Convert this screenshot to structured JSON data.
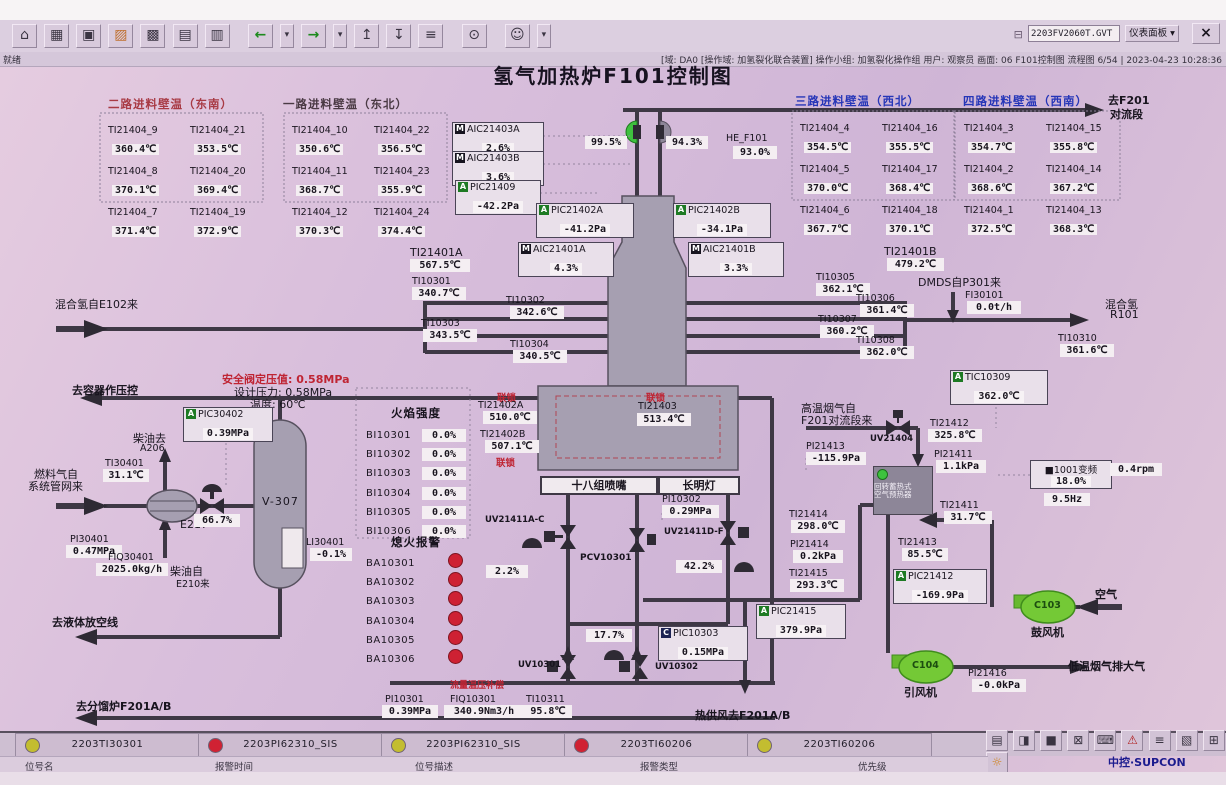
{
  "window": {
    "file_input": "2203FV2060T.GVT",
    "panel_select": "仪表面板",
    "dropdown_arrow": "▾",
    "close": "×",
    "status_ready": "就绪",
    "status_info": "[域: DA0 [操作域: 加氢裂化联合装置] 操作小组: 加氢裂化操作组  用户: 观察员  画面: 06 F101控制图 流程图 6/54 | 2023-04-23 10:28:36"
  },
  "toolbar": {
    "icons": [
      {
        "name": "home",
        "glyph": "⌂"
      },
      {
        "name": "overview",
        "glyph": "▦"
      },
      {
        "name": "flow-view",
        "glyph": "▣"
      },
      {
        "name": "furnace-view",
        "glyph": "▨"
      },
      {
        "name": "group-view",
        "glyph": "▩"
      },
      {
        "name": "trend-view",
        "glyph": "▤"
      },
      {
        "name": "report-view",
        "glyph": "▥"
      },
      {
        "name": "back",
        "glyph": "←"
      },
      {
        "name": "back-more",
        "glyph": "▾"
      },
      {
        "name": "forward",
        "glyph": "→"
      },
      {
        "name": "forward-more",
        "glyph": "▾"
      },
      {
        "name": "page-up",
        "glyph": "↥"
      },
      {
        "name": "page-down",
        "glyph": "↧"
      },
      {
        "name": "log",
        "glyph": "≡"
      },
      {
        "name": "find",
        "glyph": "⊙"
      },
      {
        "name": "operator",
        "glyph": "☺"
      },
      {
        "name": "operator-more",
        "glyph": "▾"
      }
    ],
    "file_icon": "⊟"
  },
  "title": "氢气加热炉F101控制图",
  "walls": [
    {
      "header": "二路进料壁温（东南）",
      "cells": [
        [
          "TI21404_9",
          "360.4℃"
        ],
        [
          "TI21404_21",
          "353.5℃"
        ],
        [
          "TI21404_8",
          "370.1℃"
        ],
        [
          "TI21404_20",
          "369.4℃"
        ],
        [
          "TI21404_7",
          "371.4℃"
        ],
        [
          "TI21404_19",
          "372.9℃"
        ]
      ]
    },
    {
      "header": "一路进料壁温（东北）",
      "cells": [
        [
          "TI21404_10",
          "350.6℃"
        ],
        [
          "TI21404_22",
          "356.5℃"
        ],
        [
          "TI21404_11",
          "368.7℃"
        ],
        [
          "TI21404_23",
          "355.9℃"
        ],
        [
          "TI21404_12",
          "370.3℃"
        ],
        [
          "TI21404_24",
          "374.4℃"
        ]
      ]
    },
    {
      "header": "三路进料壁温（西北）",
      "cells": [
        [
          "TI21404_4",
          "354.5℃"
        ],
        [
          "TI21404_16",
          "355.5℃"
        ],
        [
          "TI21404_5",
          "370.0℃"
        ],
        [
          "TI21404_17",
          "368.4℃"
        ],
        [
          "TI21404_6",
          "367.7℃"
        ],
        [
          "TI21404_18",
          "370.1℃"
        ]
      ]
    },
    {
      "header": "四路进料壁温（西南）",
      "cells": [
        [
          "TI21404_3",
          "354.7℃"
        ],
        [
          "TI21404_15",
          "355.8℃"
        ],
        [
          "TI21404_2",
          "368.6℃"
        ],
        [
          "TI21404_14",
          "367.2℃"
        ],
        [
          "TI21404_1",
          "372.5℃"
        ],
        [
          "TI21404_13",
          "368.3℃"
        ]
      ]
    }
  ],
  "points": {
    "AIC21403A": {
      "badge": "M",
      "tag": "AIC21403A",
      "value": "2.6%"
    },
    "AIC21403B": {
      "badge": "M",
      "tag": "AIC21403B",
      "value": "3.6%"
    },
    "PIC21409": {
      "badge": "A",
      "tag": "PIC21409",
      "value": "-42.2Pa"
    },
    "PIC21402A": {
      "badge": "A",
      "tag": "PIC21402A",
      "value": "-41.2Pa"
    },
    "PIC21402B": {
      "badge": "A",
      "tag": "PIC21402B",
      "value": "-34.1Pa"
    },
    "AIC21401A": {
      "badge": "M",
      "tag": "AIC21401A",
      "value": "4.3%"
    },
    "AIC21401B": {
      "badge": "M",
      "tag": "AIC21401B",
      "value": "3.3%"
    },
    "HE_F101": {
      "tag": "HE_F101",
      "value": "93.0%"
    },
    "TI21401A": {
      "tag": "TI21401A",
      "value": "567.5℃"
    },
    "TI21401B": {
      "tag": "TI21401B",
      "value": "479.2℃"
    },
    "TI10301": {
      "tag": "TI10301",
      "value": "340.7℃"
    },
    "TI10302": {
      "tag": "TI10302",
      "value": "342.6℃"
    },
    "TI10303": {
      "tag": "TI10303",
      "value": "343.5℃"
    },
    "TI10304": {
      "tag": "TI10304",
      "value": "340.5℃"
    },
    "TI10305": {
      "tag": "TI10305",
      "value": "362.1℃"
    },
    "TI10306": {
      "tag": "TI10306",
      "value": "361.4℃"
    },
    "TI10307": {
      "tag": "TI10307",
      "value": "360.2℃"
    },
    "TI10308": {
      "tag": "TI10308",
      "value": "362.0℃"
    },
    "TI10310": {
      "tag": "TI10310",
      "value": "361.6℃"
    },
    "FI30101": {
      "tag": "FI30101",
      "value": "0.0t/h"
    },
    "TIC10309": {
      "badge": "A",
      "tag": "TIC10309",
      "value": "362.0℃"
    },
    "TI21402A": {
      "tag": "TI21402A",
      "value": "510.0℃"
    },
    "TI21402B": {
      "tag": "TI21402B",
      "value": "507.1℃"
    },
    "TI21403": {
      "tag": "TI21403",
      "value": "513.4℃"
    },
    "PI10302": {
      "tag": "PI10302",
      "value": "0.29MPa"
    },
    "PIC10303": {
      "badge": "C",
      "tag": "PIC10303",
      "value": "0.15MPa"
    },
    "PI10301": {
      "tag": "PI10301",
      "value": "0.39MPa"
    },
    "FIQ10301": {
      "tag": "FIQ10301",
      "value": "340.9Nm3/h"
    },
    "TI10311": {
      "tag": "TI10311",
      "value": "95.8℃"
    },
    "PIC30402": {
      "badge": "A",
      "tag": "PIC30402",
      "value": "0.39MPa"
    },
    "TI30401": {
      "tag": "TI30401",
      "value": "31.1℃"
    },
    "PI30401": {
      "tag": "PI30401",
      "value": "0.47MPa"
    },
    "FIQ30401": {
      "tag": "FIQ30401",
      "value": "2025.0kg/h"
    },
    "LI30401": {
      "tag": "LI30401",
      "value": "-0.1%"
    },
    "PI21413": {
      "tag": "PI21413",
      "value": "-115.9Pa"
    },
    "TI21412": {
      "tag": "TI21412",
      "value": "325.8℃"
    },
    "PI21411": {
      "tag": "PI21411",
      "value": "1.1kPa"
    },
    "TI21411": {
      "tag": "TI21411",
      "value": "31.7℃"
    },
    "TI21414": {
      "tag": "TI21414",
      "value": "298.0℃"
    },
    "PI21414": {
      "tag": "PI21414",
      "value": "0.2kPa"
    },
    "TI21415": {
      "tag": "TI21415",
      "value": "293.3℃"
    },
    "PIC21415": {
      "badge": "A",
      "tag": "PIC21415",
      "value": "379.9Pa"
    },
    "TI21413": {
      "tag": "TI21413",
      "value": "85.5℃"
    },
    "PIC21412": {
      "badge": "A",
      "tag": "PIC21412",
      "value": "-169.9Pa"
    },
    "PI21416": {
      "tag": "PI21416",
      "value": "-0.0kPa"
    }
  },
  "valves": {
    "stack_left": "99.5%",
    "stack_right": "94.3%",
    "fuel": "66.7%",
    "burner_a": "2.2%",
    "burner_b": "17.7%",
    "pilot": "42.2%"
  },
  "vfd": {
    "icon": "■",
    "name": "1001变频",
    "pct": "18.0%",
    "hz": "9.5Hz",
    "rpm": "0.4rpm"
  },
  "fire": {
    "header": "火焰强度",
    "items": [
      {
        "tag": "BI10301",
        "value": "0.0%"
      },
      {
        "tag": "BI10302",
        "value": "0.0%"
      },
      {
        "tag": "BI10303",
        "value": "0.0%"
      },
      {
        "tag": "BI10304",
        "value": "0.0%"
      },
      {
        "tag": "BI10305",
        "value": "0.0%"
      },
      {
        "tag": "BI10306",
        "value": "0.0%"
      }
    ]
  },
  "flameout": {
    "header": "熄火报警",
    "tags": [
      "BA10301",
      "BA10302",
      "BA10303",
      "BA10304",
      "BA10305",
      "BA10306"
    ]
  },
  "labels": {
    "to_f201_1": "去F201",
    "to_f201_2": "对流段",
    "h2_in": "混合氢自E102来",
    "dmds": "DMDS自P301来",
    "h2_out_1": "混合氢",
    "h2_out_2": "R101",
    "to_vessel": "去容器作压控",
    "safety": "安全阀定压值: 0.58MPa",
    "design_p": "设计压力: 0.58MPa",
    "design_t": "温度: 60℃",
    "diesel_to_1": "柴油去",
    "diesel_to_2": "A206",
    "fuelgas_1": "燃料气自",
    "fuelgas_2": "系统管网来",
    "e217": "E217",
    "v307": "V-307",
    "diesel_from_1": "柴油自",
    "diesel_from_2": "E210来",
    "to_flare": "去液体放空线",
    "to_f201ab": "去分馏炉F201A/B",
    "nozzles": "十八组喷嘴",
    "pilot_burner": "长明灯",
    "hot_flue_1": "高温烟气自",
    "hot_flue_2": "F201对流段来",
    "preheater_1": "回转蓄热式",
    "preheater_2": "空气预热器",
    "blower": "鼓风机",
    "inducer": "引风机",
    "c103": "C103",
    "c104": "C104",
    "air": "空气",
    "flue_out": "低温烟气排大气",
    "hot_air": "热供风去F201A/B",
    "compensation": "流量温压补偿",
    "interlock": "联锁",
    "uv21411ac": "UV21411A-C",
    "pcv10301": "PCV10301",
    "uv10301": "UV10301",
    "uv10302": "UV10302",
    "uv21411df": "UV21411D-F",
    "uv21404": "UV21404"
  },
  "alarmbar": {
    "entries": [
      {
        "color": "yellow",
        "tag": "2203TI30301"
      },
      {
        "color": "red",
        "tag": "2203PI62310_SIS"
      },
      {
        "color": "yellow",
        "tag": "2203PI62310_SIS"
      },
      {
        "color": "red",
        "tag": "2203TI60206"
      },
      {
        "color": "yellow",
        "tag": "2203TI60206"
      }
    ],
    "fields": [
      "位号名",
      "报警时间",
      "位号描述",
      "报警类型",
      "优先级"
    ],
    "icons": [
      {
        "name": "printer",
        "glyph": "▤"
      },
      {
        "name": "unlock",
        "glyph": "◨"
      },
      {
        "name": "screen",
        "glyph": "■"
      },
      {
        "name": "alarm-screen",
        "glyph": "⊠"
      },
      {
        "name": "keyboard",
        "glyph": "⌨"
      },
      {
        "name": "alarm-bell",
        "glyph": "⚠"
      },
      {
        "name": "alarm-list",
        "glyph": "≡"
      },
      {
        "name": "report-page",
        "glyph": "▧"
      },
      {
        "name": "window-layout",
        "glyph": "⊞"
      },
      {
        "name": "alarm-lamp",
        "glyph": "☼"
      }
    ],
    "logo": "中控·SUPCON"
  }
}
